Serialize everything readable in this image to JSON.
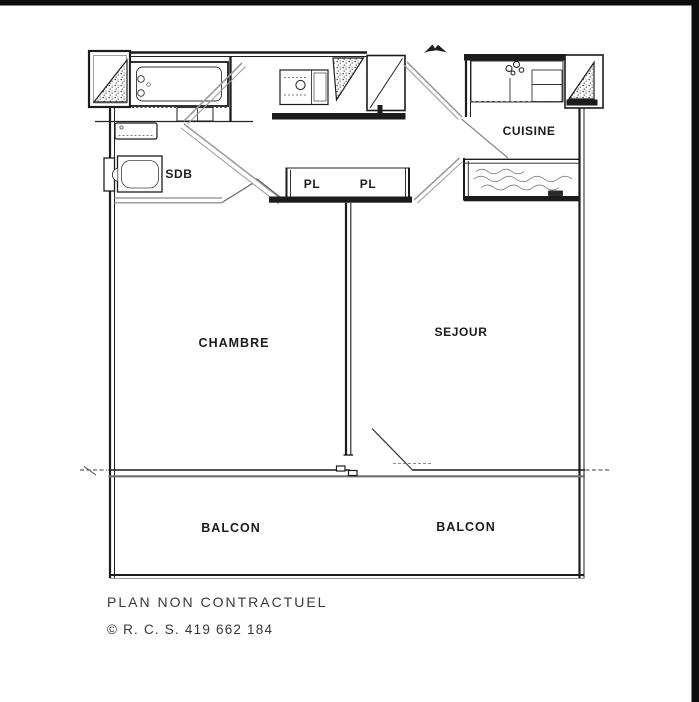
{
  "canvas": {
    "background": "#ffffff",
    "frame_bar_color": "#0d0d0d"
  },
  "plan": {
    "labels": {
      "sdb": "SDB",
      "cuisine": "CUISINE",
      "pl_left": "PL",
      "pl_right": "PL",
      "chambre": "CHAMBRE",
      "sejour": "SEJOUR",
      "balcon_left": "BALCON",
      "balcon_right": "BALCON"
    },
    "colors": {
      "wall": "#1c1c1c",
      "partition_gray": "#9e9e9e",
      "facade_gray": "#6f6f6f"
    },
    "icons": {
      "north_arrow": "north-arrow",
      "bathtub": "bathtub",
      "washbasin": "washbasin",
      "toilet": "toilet",
      "kitchen_sink": "kitchen-sink",
      "wall_hatch": "speckled-triangle"
    }
  },
  "footer": {
    "disclaimer": "PLAN NON CONTRACTUEL",
    "registration": "© R. C. S. 419 662 184"
  }
}
